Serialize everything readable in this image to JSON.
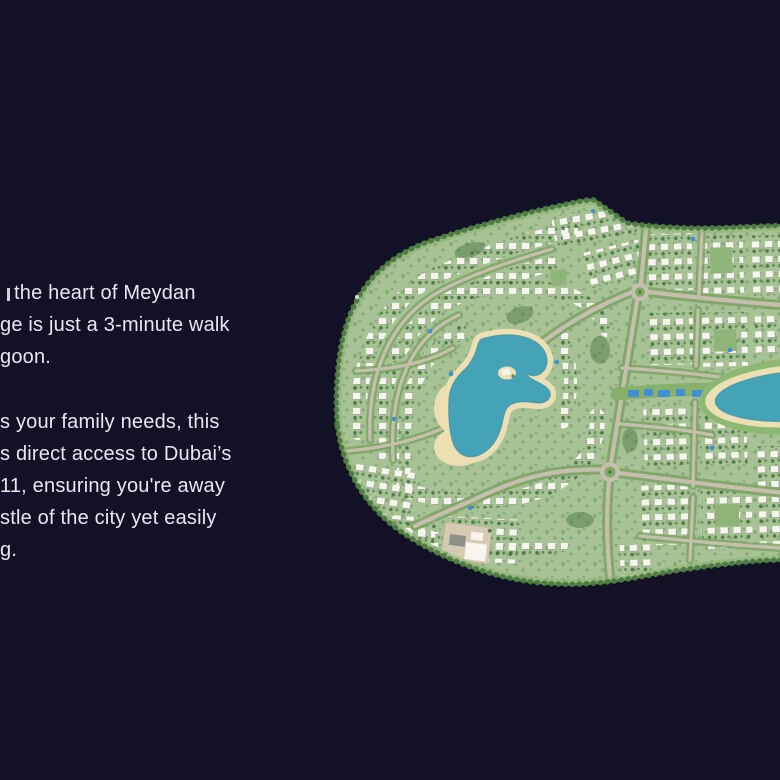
{
  "copy": {
    "p1": [
      "the heart of Meydan",
      "ge is just a 3-minute walk",
      "goon."
    ],
    "p2": [
      "s your family needs, this",
      "s direct access to Dubai’s",
      "11, ensuring you're away",
      "stle of the city yet easily",
      "g."
    ]
  },
  "map": {
    "semantic": "community-masterplan-site-map",
    "features": [
      "villa-clusters",
      "central-lagoon",
      "right-lagoon",
      "canal-with-pools",
      "roundabouts",
      "school-plaza",
      "tree-lined-boundary"
    ]
  },
  "colors": {
    "bg": "#131126",
    "text": "#e9e7f2",
    "land": "#a7c295",
    "land_edge": "#4c7a42",
    "tree": "#3e6e3b",
    "road": "#c6bfae",
    "verge": "#7da565",
    "villa": "#f7f5ef",
    "villa_shadow": "#999788",
    "water": "#45a3b8",
    "beach": "#ecdfb4",
    "pool": "#3f8fd2",
    "plaza": "#d6cab3",
    "park": "#8fb479"
  }
}
